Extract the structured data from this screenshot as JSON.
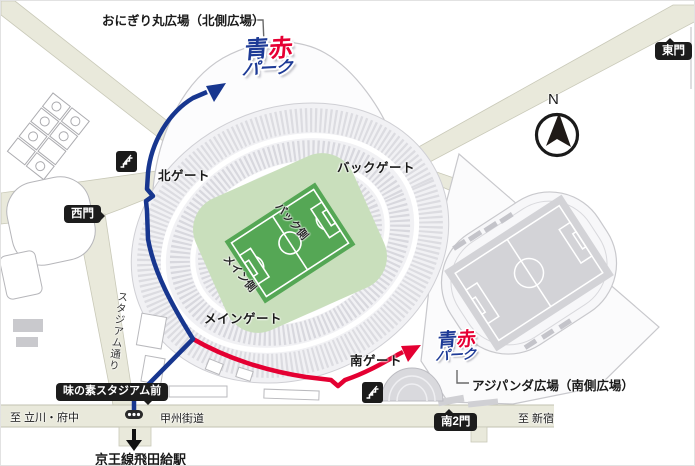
{
  "logo": {
    "ao": "青",
    "aka": "赤",
    "park": "パーク"
  },
  "plazas": {
    "north": "おにぎり丸広場（北側広場）",
    "south": "アジパンダ広場（南側広場）"
  },
  "gates": {
    "north": "北ゲート",
    "back": "バックゲート",
    "main": "メインゲート",
    "south": "南ゲート"
  },
  "badges": {
    "west": "西門",
    "east": "東門",
    "south2": "南2門",
    "bus_stop": "味の素スタジアム前"
  },
  "pitch_sides": {
    "back": "バック側",
    "main": "メイン側"
  },
  "roads": {
    "koshu_kaido": "甲州街道",
    "stadium_street": "スタジアム通り"
  },
  "directions": {
    "to_tachikawa_fuchu": "至 立川・府中",
    "to_shinjuku": "至 新宿"
  },
  "station": {
    "name": "京王線飛田給駅"
  },
  "compass": {
    "north_label": "N"
  },
  "colors": {
    "route_blue": "#17368f",
    "route_red": "#e40032",
    "road_beige": "#e9e9db",
    "pitch_green": "#55a755",
    "pitch_surround_green": "#c9dfbc",
    "practice_field_gray": "#d3d3d7",
    "badge_black": "#1c1c1c"
  }
}
